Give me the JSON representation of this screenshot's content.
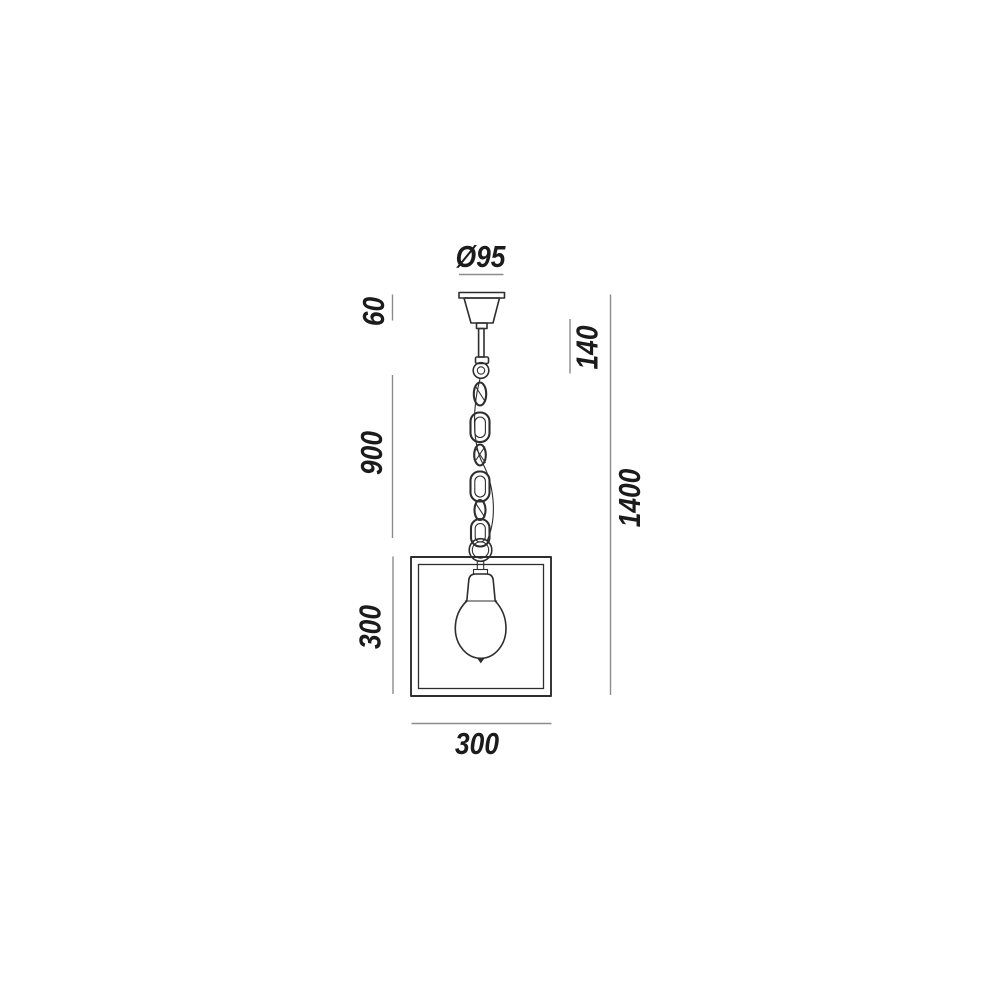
{
  "dimensions": {
    "canopy_diameter": "Ø95",
    "canopy_height": "60",
    "suspension_top": "140",
    "chain_length": "900",
    "frame_height": "300",
    "total_height": "1400",
    "frame_width": "300"
  },
  "colors": {
    "background": "#ffffff",
    "line": "#2e2e2e",
    "dimline": "#8c8c8c",
    "label": "#1b1b1b"
  }
}
